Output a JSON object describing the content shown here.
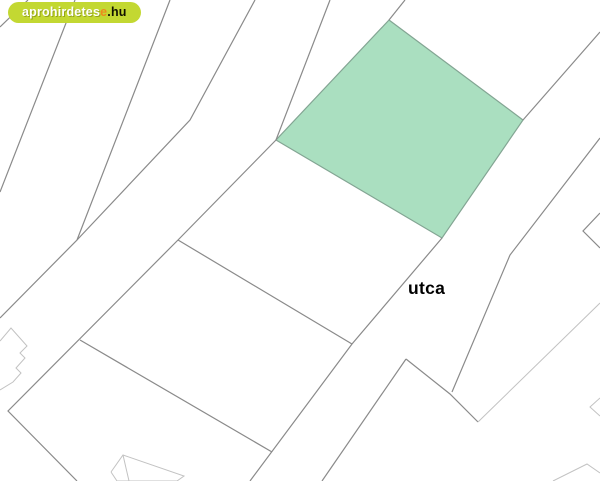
{
  "logo": {
    "text_white": "aprohirdetes",
    "text_orange": "e",
    "text_dark": ".hu",
    "bg_color": "#c3d832",
    "orange_color": "#ee8a1c"
  },
  "map": {
    "street_label": "utca",
    "background": "#ffffff",
    "colors": {
      "dark_line": "#8a8a8a",
      "light_line": "#c2c2c2",
      "parcel_fill": "#aadfc0",
      "parcel_stroke": "#83a593"
    },
    "highlighted_parcel": {
      "name": "highlighted-parcel",
      "points": [
        [
          389,
          20
        ],
        [
          523,
          120
        ],
        [
          442,
          238
        ],
        [
          276,
          140
        ]
      ]
    },
    "lines": [
      {
        "name": "boundary-corner-top-left",
        "tone": "dark",
        "points": [
          [
            28,
            0
          ],
          [
            0,
            27
          ]
        ]
      },
      {
        "name": "boundary-behind-logo",
        "tone": "dark",
        "points": [
          [
            75,
            0
          ],
          [
            0,
            192
          ]
        ]
      },
      {
        "name": "boundary-long-left",
        "tone": "dark",
        "points": [
          [
            170,
            0
          ],
          [
            77,
            240
          ],
          [
            0,
            318
          ]
        ]
      },
      {
        "name": "boundary-upper-left-mid",
        "tone": "dark",
        "points": [
          [
            255,
            0
          ],
          [
            190,
            120
          ],
          [
            77,
            240
          ]
        ]
      },
      {
        "name": "boundary-top-to-parcel",
        "tone": "dark",
        "points": [
          [
            330,
            0
          ],
          [
            276,
            140
          ]
        ]
      },
      {
        "name": "boundary-parcel-top-extension",
        "tone": "dark",
        "points": [
          [
            405,
            0
          ],
          [
            389,
            20
          ]
        ]
      },
      {
        "name": "boundary-main-diagonal",
        "tone": "dark",
        "points": [
          [
            276,
            140
          ],
          [
            178,
            240
          ],
          [
            8,
            411
          ],
          [
            77,
            481
          ]
        ]
      },
      {
        "name": "boundary-cross-upper",
        "tone": "dark",
        "points": [
          [
            178,
            240
          ],
          [
            352,
            344
          ]
        ]
      },
      {
        "name": "boundary-cross-lower",
        "tone": "dark",
        "points": [
          [
            80,
            340
          ],
          [
            272,
            452
          ]
        ]
      },
      {
        "name": "street-west-edge",
        "tone": "dark",
        "points": [
          [
            442,
            238
          ],
          [
            352,
            344
          ],
          [
            250,
            481
          ]
        ]
      },
      {
        "name": "street-east-edge-lower",
        "tone": "dark",
        "points": [
          [
            406,
            359
          ],
          [
            322,
            481
          ]
        ]
      },
      {
        "name": "parcel-corner-southeast",
        "tone": "dark",
        "points": [
          [
            406,
            359
          ],
          [
            450,
            394
          ],
          [
            478,
            422
          ]
        ]
      },
      {
        "name": "street-northeast-west-edge",
        "tone": "dark",
        "points": [
          [
            523,
            120
          ],
          [
            600,
            32
          ]
        ]
      },
      {
        "name": "street-northeast-east-edge",
        "tone": "dark",
        "points": [
          [
            600,
            138
          ],
          [
            510,
            255
          ],
          [
            452,
            392
          ]
        ]
      },
      {
        "name": "notch-right-top",
        "tone": "dark",
        "points": [
          [
            600,
            213
          ],
          [
            583,
            231
          ],
          [
            600,
            248
          ]
        ]
      },
      {
        "name": "parcel-edge-southeast",
        "tone": "light",
        "points": [
          [
            478,
            422
          ],
          [
            600,
            303
          ]
        ]
      },
      {
        "name": "notch-right-middle",
        "tone": "light",
        "points": [
          [
            600,
            398
          ],
          [
            590,
            407
          ],
          [
            600,
            416
          ]
        ]
      },
      {
        "name": "parcel-peak-bottom-right",
        "tone": "light",
        "points": [
          [
            553,
            481
          ],
          [
            587,
            464
          ],
          [
            600,
            473
          ]
        ]
      },
      {
        "name": "building-footprint-left",
        "tone": "light",
        "points": [
          [
            0,
            341
          ],
          [
            11,
            328
          ],
          [
            27,
            346
          ],
          [
            20,
            353
          ],
          [
            25,
            358
          ],
          [
            16,
            368
          ],
          [
            21,
            373
          ],
          [
            13,
            382
          ],
          [
            0,
            390
          ]
        ]
      },
      {
        "name": "building-footprint-bottom",
        "tone": "light",
        "points": [
          [
            111,
            472
          ],
          [
            123,
            455
          ],
          [
            184,
            476
          ],
          [
            177,
            481
          ],
          [
            117,
            481
          ],
          [
            111,
            472
          ]
        ]
      },
      {
        "name": "building-footprint-bottom-inner",
        "tone": "light",
        "points": [
          [
            123,
            455
          ],
          [
            129,
            481
          ]
        ]
      }
    ]
  }
}
